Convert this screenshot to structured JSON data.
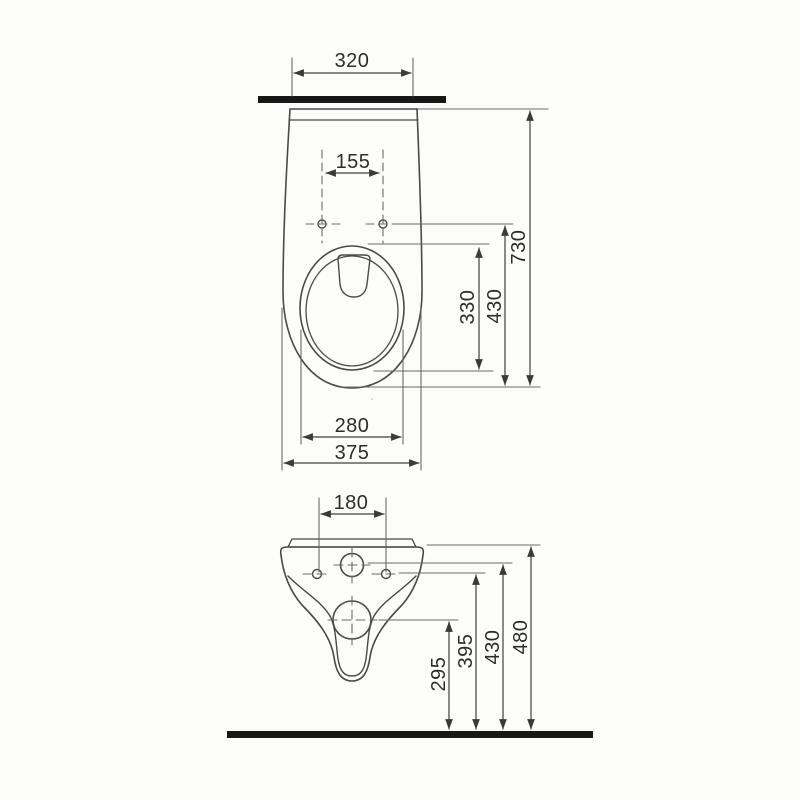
{
  "drawing": {
    "description": "Wall-hung toilet installation dimension drawing, two views",
    "units": "mm",
    "line_color": "#4a4a4a",
    "heavy_line_color": "#181818",
    "top_view": {
      "name": "plan-view",
      "dims": {
        "install_width": "320",
        "hole_spacing": "155",
        "bowl_opening_length": "330",
        "hole_depth": "430",
        "overall_depth": "730",
        "bowl_opening_width": "280",
        "overall_width": "375"
      }
    },
    "front_view": {
      "name": "rear-elevation-view",
      "dims": {
        "hole_spacing": "180",
        "outlet_center_height": "295",
        "fixing_hole_height": "395",
        "inlet_center_height": "430",
        "rim_height": "480"
      }
    }
  }
}
